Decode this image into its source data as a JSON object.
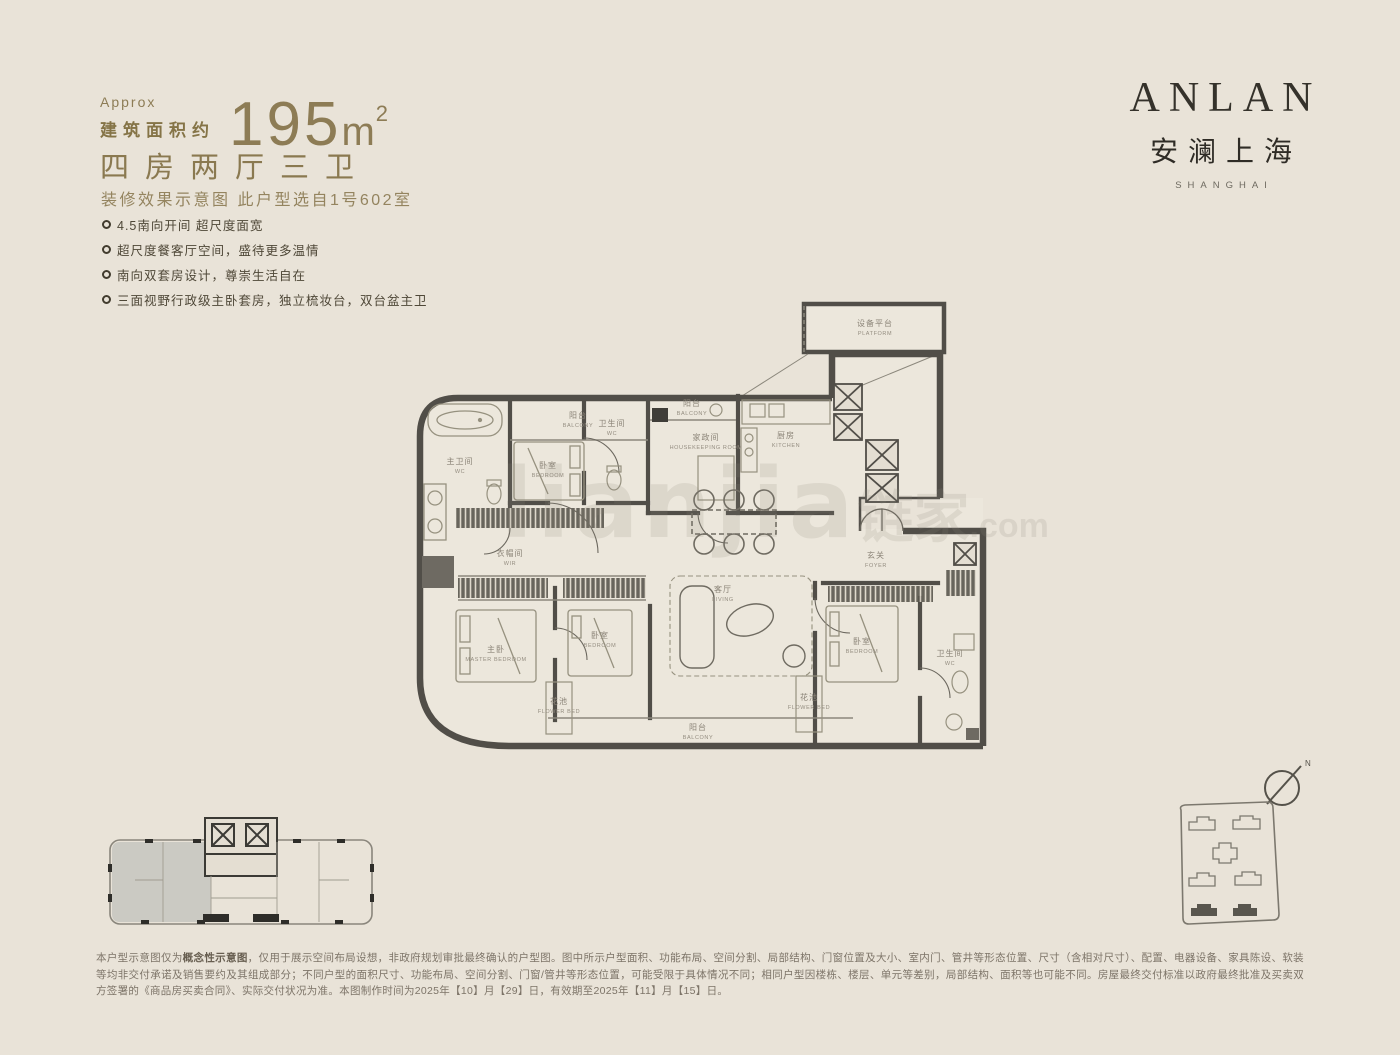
{
  "header": {
    "approx_label": "Approx",
    "area_label": "建筑面积约",
    "area_value": "195",
    "area_unit": "m",
    "area_sup": "2",
    "layout_title": "四房两厅三卫",
    "subtitle": "装修效果示意图 此户型选自1号602室",
    "accent_color": "#8d7c55"
  },
  "features": {
    "items": [
      "4.5南向开间 超尺度面宽",
      "超尺度餐客厅空间，盛待更多温情",
      "南向双套房设计，尊崇生活自在",
      "三面视野行政级主卧套房，独立梳妆台，双台盆主卫"
    ]
  },
  "brand": {
    "name": "ANLAN",
    "cn": "安澜上海",
    "sub": "SHANGHAI"
  },
  "plan": {
    "rooms": [
      {
        "cn": "设备平台",
        "en": "PLATFORM"
      },
      {
        "cn": "阳台",
        "en": "BALCONY"
      },
      {
        "cn": "卧室",
        "en": "BEDROOM"
      },
      {
        "cn": "卫生间",
        "en": "WC"
      },
      {
        "cn": "阳台",
        "en": "BALCONY"
      },
      {
        "cn": "家政间",
        "en": "HOUSEKEEPING ROOM"
      },
      {
        "cn": "厨房",
        "en": "KITCHEN"
      },
      {
        "cn": "主卫间",
        "en": "WC"
      },
      {
        "cn": "衣帽间",
        "en": "WIR"
      },
      {
        "cn": "客厅",
        "en": "LIVING"
      },
      {
        "cn": "玄关",
        "en": "FOYER"
      },
      {
        "cn": "主卧",
        "en": "MASTER BEDROOM"
      },
      {
        "cn": "卧室",
        "en": "BEDROOM"
      },
      {
        "cn": "卧室",
        "en": "BEDROOM"
      },
      {
        "cn": "卫生间",
        "en": "WC"
      },
      {
        "cn": "阳台",
        "en": "BALCONY"
      },
      {
        "cn": "花池",
        "en": "FLOWER BED"
      },
      {
        "cn": "花池",
        "en": "FLOWER BED"
      }
    ],
    "compass_label": "N",
    "watermark": {
      "latin": "lianjia",
      "cn": "链家",
      "suffix": ".com"
    },
    "wall_color": "#514e48",
    "furniture_color": "#96917f"
  },
  "footer": {
    "line_prefix": "本户型示意图仅为",
    "line_bold": "概念性示意图",
    "line_rest": "，仅用于展示空间布局设想，非政府规划审批最终确认的户型图。图中所示户型面积、功能布局、空间分割、局部结构、门窗位置及大小、室内门、管井等形态位置、尺寸（含相对尺寸）、配置、电器设备、家具陈设、软装等均非交付承诺及销售要约及其组成部分；不同户型的面积尺寸、功能布局、空间分割、门窗/管井等形态位置，可能受限于具体情况不同；相同户型因楼栋、楼层、单元等差别，局部结构、面积等也可能不同。房屋最终交付标准以政府最终批准及买卖双方签署的《商品房买卖合同》、实际交付状况为准。本图制作时间为2025年【10】月【29】日，有效期至2025年【11】月【15】日。"
  }
}
